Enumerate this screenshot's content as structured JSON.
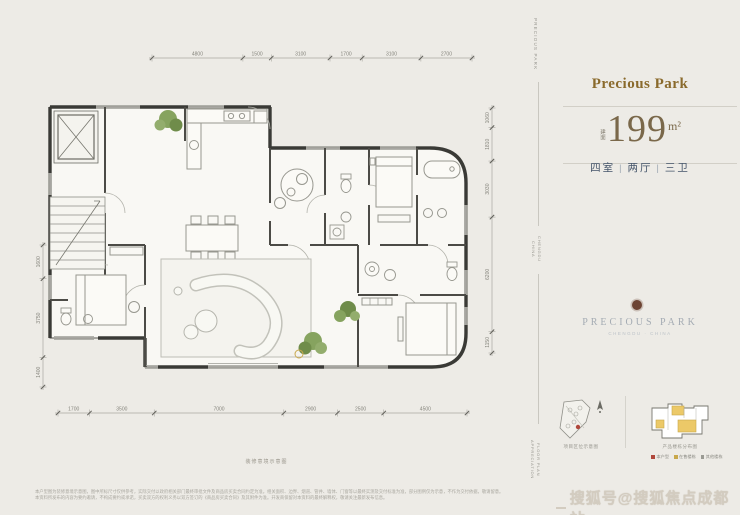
{
  "palette": {
    "bg": "#edebe6",
    "gold": "#8a6a2c",
    "bronze": "#7a684a",
    "navy": "#44546a",
    "wall": "#3a3a36",
    "dim_label": "#85847c",
    "accent_red": "#b0483c",
    "accent_yellow": "#ecc968",
    "plant_green": "#86a35f",
    "watermark": "#d3ccc0"
  },
  "title_block": {
    "brand": "Precious Park",
    "area_prefix": "建面",
    "area_value": "199",
    "area_unit": "m²",
    "tags": [
      "四室",
      "两厅",
      "三卫"
    ],
    "tag_separator": "|"
  },
  "side_rail": {
    "top": "PRECIOUS PARK",
    "middle": "CHENGDU CHINA",
    "bottom": "FLOOR PLAN APPRECIATION"
  },
  "logo_block": {
    "name": "PRECIOUS PARK",
    "subtitle": "CHENGDU · CHINA"
  },
  "floor_plan": {
    "caption": "装修意境示意图",
    "dims_top": [
      4800,
      1500,
      3100,
      1700,
      3100,
      2700
    ],
    "dims_bottom": [
      1700,
      3500,
      7000,
      2900,
      2500,
      4500
    ],
    "dims_left": [
      1600,
      3750,
      1400
    ],
    "dims_right": [
      1060,
      1810,
      3030,
      6200,
      1150
    ]
  },
  "mini_maps": {
    "site_caption": "项目区位示意图",
    "key_caption": "产品楼栋分布图",
    "legend": [
      {
        "color": "#b0483c",
        "label": "本户型"
      },
      {
        "color": "#c8a84b",
        "label": "在售楼栋"
      },
      {
        "color": "#9a9a93",
        "label": "其他楼栋"
      }
    ]
  },
  "disclaimer": {
    "line1": "本户型图为装修意境示意图，图中所标尺寸仅供参考，实际交付以政府相关部门最终审批文件及商品房买卖合同约定为准。相关面积、边界、烟道、管井、墙体、门窗等以最终实测及交付标准为准，部分图例仅为示意，不作为交付依据，敬请留意。",
    "line2": "本资料所发布的内容为要约邀请，不构成要约或承诺，买卖双方的权利义务以双方签订的《商品房买卖合同》及其附件为准。开发商保留对本资料的最终解释权，敬请关注最新发布信息。"
  },
  "watermark": "搜狐号@搜狐焦点成都站"
}
